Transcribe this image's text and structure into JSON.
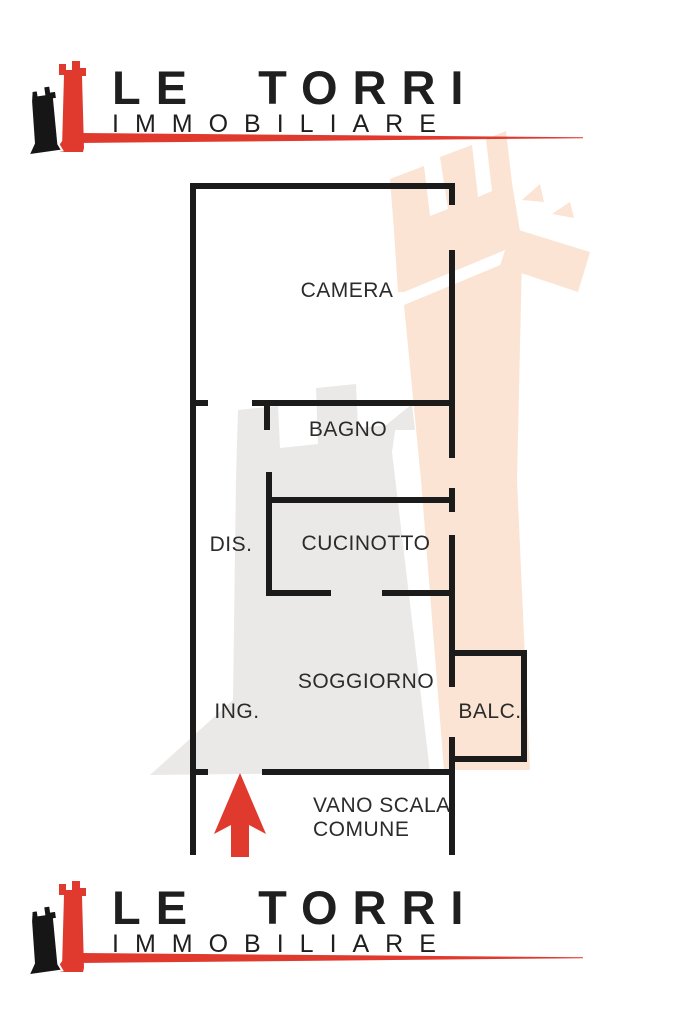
{
  "brand": {
    "name": "LE TORRI",
    "subtitle": "IMMOBILIARE"
  },
  "colors": {
    "accent": "#e03a2e",
    "wall": "#1b1b1b",
    "label_text": "#2b2b2b",
    "watermark_peach": "#fbe4d3",
    "watermark_gray": "#ebe9e7"
  },
  "floorplan": {
    "rooms": {
      "camera": "CAMERA",
      "bagno": "BAGNO",
      "dis": "DIS.",
      "cucinotto": "CUCINOTTO",
      "soggiorno": "SOGGIORNO",
      "ing": "ING.",
      "balc": "BALC.",
      "vano_scala_line1": "VANO SCALA",
      "vano_scala_line2": "COMUNE"
    },
    "entrance_arrow_direction": "up"
  }
}
